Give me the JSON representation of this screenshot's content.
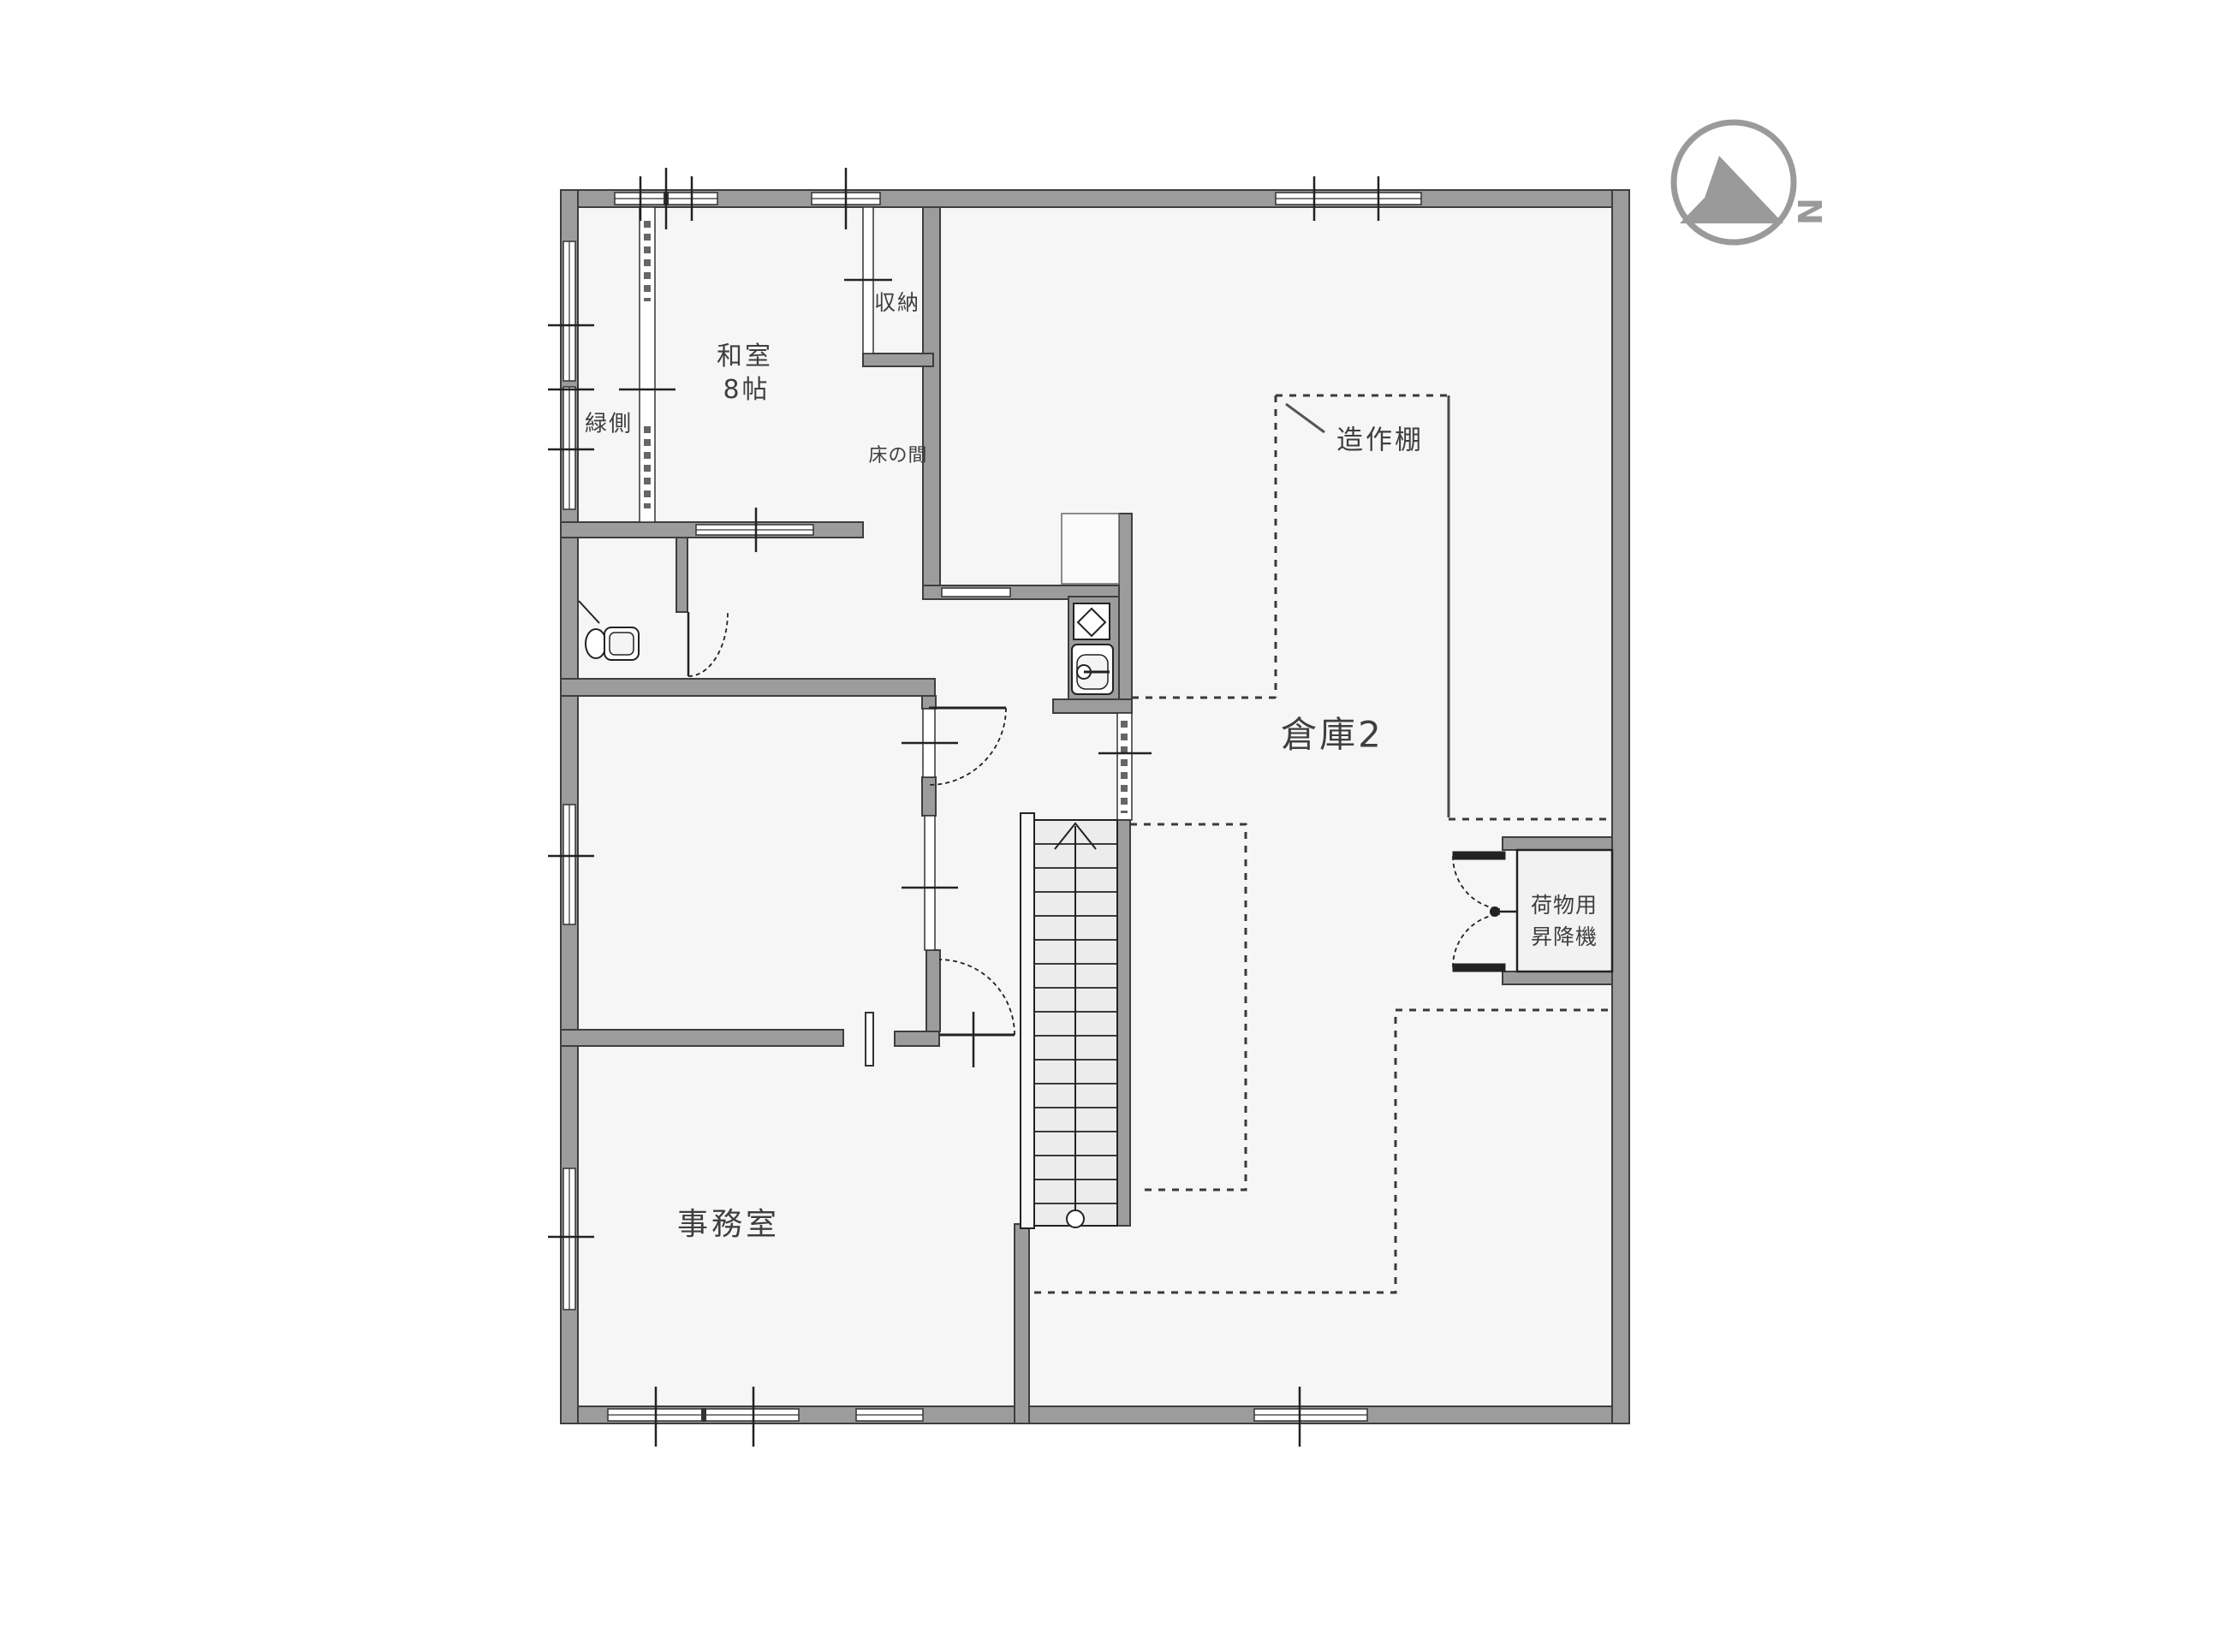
{
  "title": "floor-plan",
  "rooms": {
    "washitsu": {
      "name": "和室",
      "size": "8帖"
    },
    "engawa": {
      "name": "緑側"
    },
    "closet": {
      "name": "収納"
    },
    "tokonoma": {
      "name": "床の間"
    },
    "warehouse": {
      "name": "倉庫2"
    },
    "office": {
      "name": "事務室"
    },
    "built_in_shelf": {
      "name": "造作棚"
    },
    "cargo_lift": {
      "name_line1": "荷物用",
      "name_line2": "昇降機"
    }
  },
  "compass": {
    "label": "N"
  },
  "colors": {
    "background": "#ffffff",
    "wall_fill": "#9c9c9c",
    "wall_edge": "#3e3e3e",
    "room_fill": "#f6f6f6",
    "line": "#222222",
    "dash": "#3a3a3a",
    "label": "#3f3f3f",
    "compass": "#9a9a9a",
    "stair_tread": "#ececec"
  }
}
